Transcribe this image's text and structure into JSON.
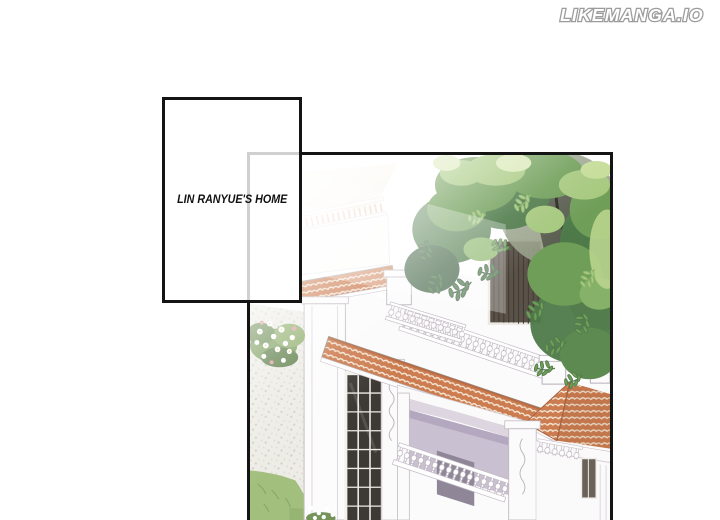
{
  "watermark": {
    "text": "LIKEMANGA.IO"
  },
  "caption": {
    "text": "LIN RANYUE'S HOME"
  },
  "panel": {
    "alt": "aerial manhwa illustration of a white mansion with terracotta tiled roofs, balustraded terraces, dark windows, a garden with gravel path, flower bush and lawn, and a large leafy tree overhanging the house",
    "colors": {
      "panel-border": "#141414",
      "caption-ink": "#111111",
      "watermark-fill": "#ffffff",
      "watermark-outline": "#9c9c9c",
      "tile": "#cd7c50",
      "tile-line": "#f5e7d4",
      "tile-shadow": "#a95f3a",
      "wall": "#fcfbfb",
      "wall-line": "#c4bcc5",
      "wall-shadow": "#c9c0d1",
      "wall-shadow-deep": "#b3a8bf",
      "window-dark": "#3d3935",
      "shutter": "#5a5248",
      "trunk": "#5b5f51",
      "foliage-dark": "#4e7a49",
      "foliage": "#6f9e58",
      "foliage-light": "#a5c87d",
      "foliage-pale": "#d8e8b4",
      "grass": "#a2bf7d",
      "gravel": "#edece6",
      "flower-pink": "#e29aa4"
    }
  }
}
